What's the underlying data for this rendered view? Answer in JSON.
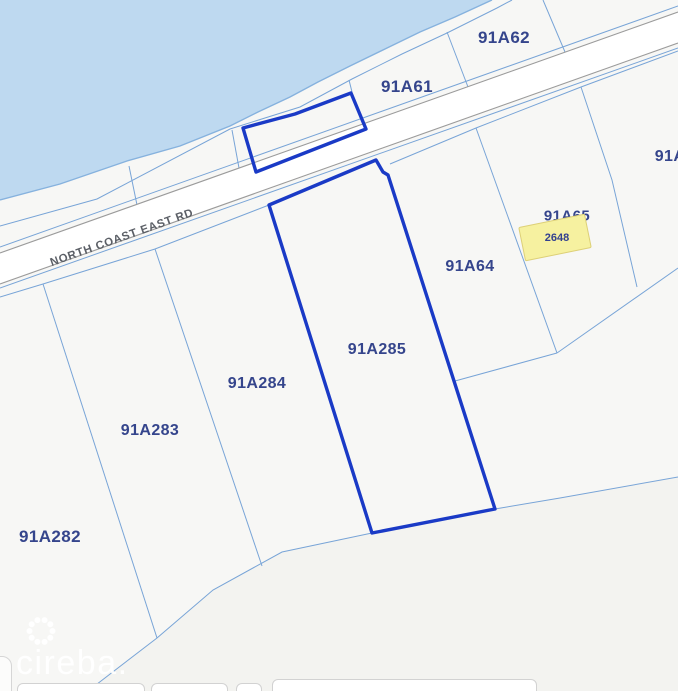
{
  "map": {
    "road_name": "NORTH COAST EAST RD",
    "parcels": [
      {
        "id": "91A62"
      },
      {
        "id": "91A61"
      },
      {
        "id": "91A"
      },
      {
        "id": "91A65"
      },
      {
        "id": "91A64"
      },
      {
        "id": "91A285",
        "highlighted": true
      },
      {
        "id": "91A284"
      },
      {
        "id": "91A283"
      },
      {
        "id": "91A282"
      }
    ],
    "highlighted_parcel": "91A285",
    "selected_plot": {
      "number": "2648"
    },
    "watermark": {
      "brand": "cireba."
    },
    "colors": {
      "water": "#bed9f0",
      "highlight": "#1a3ac6",
      "parcel_line": "#72a0d6",
      "road_casing": "#9b9b9b",
      "label_text": "#35458c",
      "plot_fill": "#f6f1a0"
    }
  }
}
